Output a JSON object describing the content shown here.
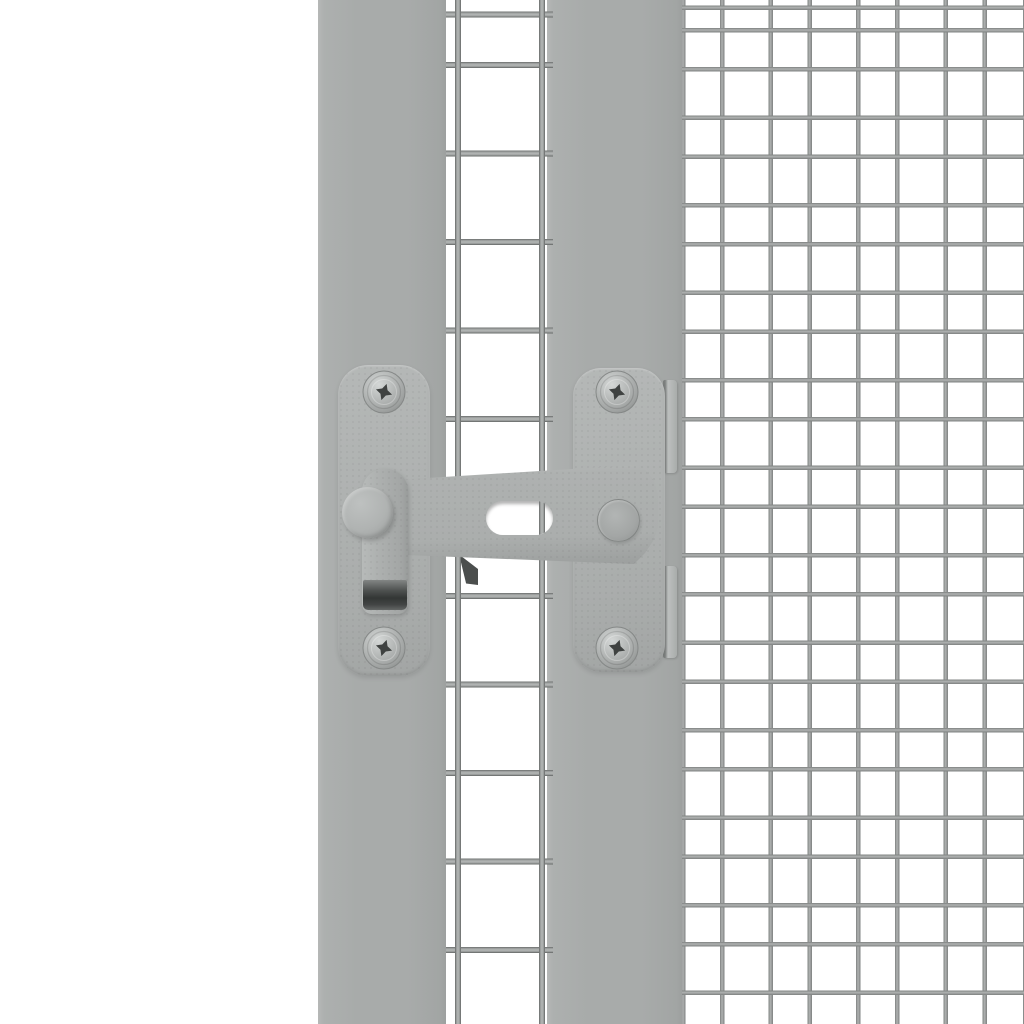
{
  "scene": {
    "type": "product-photo",
    "alt": "Close-up of a grey metal gate latch fastened with four screws across a grey frame post and the edge of a galvanised wire mesh panel on a white background",
    "background": "#ffffff"
  },
  "colors": {
    "bg": "#ffffff",
    "post": "#a8abaa",
    "plate": "#afb2b1",
    "bar": "#abaead",
    "strap": "#adb0af",
    "knob": "#b0b3b2",
    "wire-core": "#b4b7b6",
    "wire-edge": "#686b6a",
    "mesh-core": "#b0b3b2",
    "mesh-edge": "#7d807f",
    "grip": "#333635",
    "clip": "#a9acab",
    "wedge": "#4b4e4d",
    "screw-drive": "#3f4241"
  },
  "parts": {
    "left_post": "Gate frame post (left)",
    "right_post": "Gate frame post (right)",
    "strip_mesh": "Welded mesh strip of the gate door",
    "mesh_panel": "Welded wire mesh panel",
    "plate_left": "Latch mounting plate (left)",
    "plate_right": "Latch mounting plate (right)",
    "clip_top": "Retaining clip (top)",
    "clip_bottom": "Retaining clip (bottom)",
    "screw": "Pan-head screw",
    "bar": "Latch bar",
    "slot": "Latch bar slot",
    "guide_pin": "Latch guide pin",
    "strap": "Latch handle strap",
    "grip": "Latch handle grip",
    "knob": "Latch pivot knob",
    "wedge": "Catch shadow"
  }
}
